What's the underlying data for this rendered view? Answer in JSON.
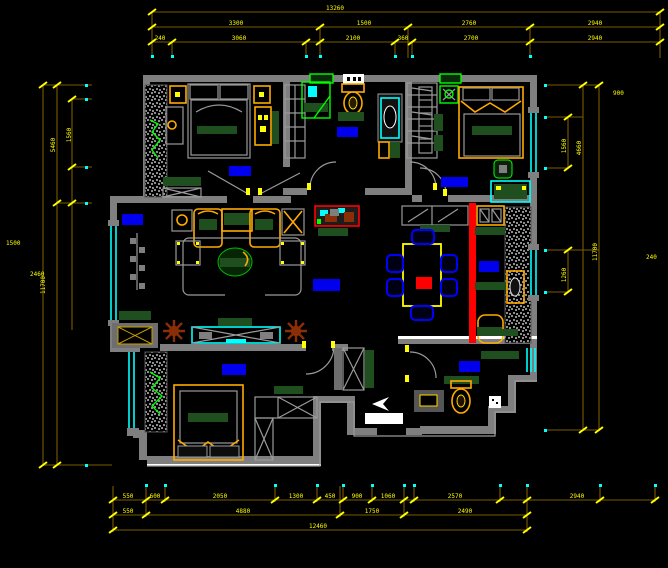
{
  "drawing": {
    "type": "cad-floor-plan",
    "background": "#000000",
    "colors": {
      "wall_gray": "#7f7f7f",
      "dim_line": "#7a5c00",
      "dim_text_yellow": "#ffff00",
      "window_cyan": "#00ffff",
      "fixture_green": "#00ff00",
      "furniture_dark_green": "#1f4f1f",
      "furniture_orange": "#ffaa00",
      "accent_red": "#ff0000",
      "label_blue": "#0000ee",
      "plant_brown": "#8a2e08",
      "white": "#ffffff"
    }
  },
  "dims": {
    "top1": [
      "13260"
    ],
    "top2": [
      "3300",
      "1500",
      "2760",
      "2940"
    ],
    "top3": [
      "240",
      "3060",
      "2100",
      "360",
      "2700",
      "2940"
    ],
    "left": [
      "11700",
      "5460",
      "1560",
      "1500",
      "2460"
    ],
    "right": [
      "4660",
      "11700",
      "1560",
      "1260",
      "240",
      "900"
    ],
    "bottom1": [
      "550",
      "600",
      "2050",
      "1300",
      "450",
      "900",
      "1060",
      "2570",
      "2940"
    ],
    "bottom2": [
      "550",
      "4880",
      "1750",
      "2490"
    ],
    "bottom3": [
      "12460"
    ]
  }
}
